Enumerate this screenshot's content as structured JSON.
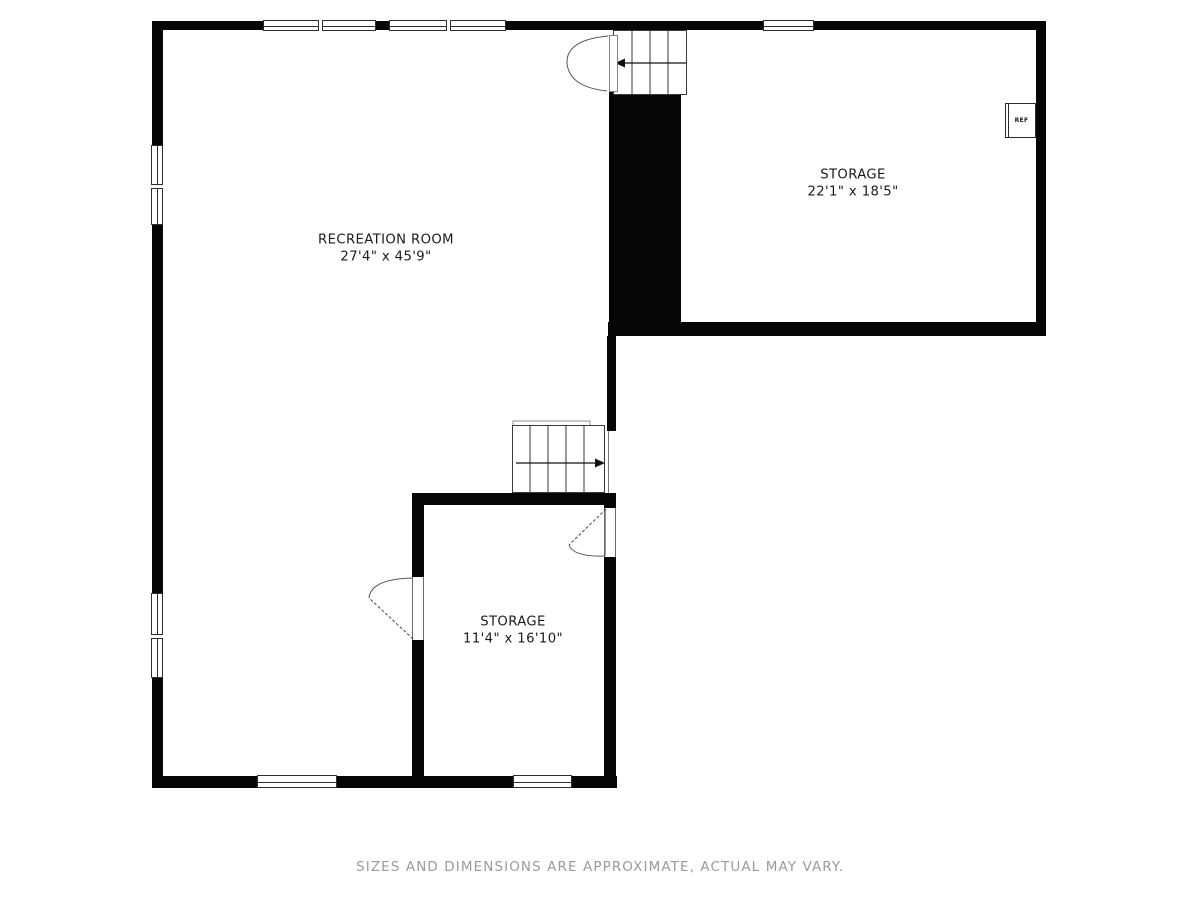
{
  "plan": {
    "rooms": [
      {
        "name": "RECREATION ROOM",
        "dimensions": "27'4\" x 45'9\""
      },
      {
        "name": "STORAGE",
        "dimensions": "22'1\" x 18'5\""
      },
      {
        "name": "STORAGE",
        "dimensions": "11'4\" x 16'10\""
      }
    ],
    "appliance": {
      "label": "REF"
    },
    "footer": {
      "disclaimer": "SIZES AND DIMENSIONS ARE APPROXIMATE, ACTUAL MAY VARY."
    },
    "colors": {
      "wall": "#060606",
      "text": "#1b1b1b",
      "disclaimer": "#9b9b9b",
      "thin": "#555555"
    }
  }
}
